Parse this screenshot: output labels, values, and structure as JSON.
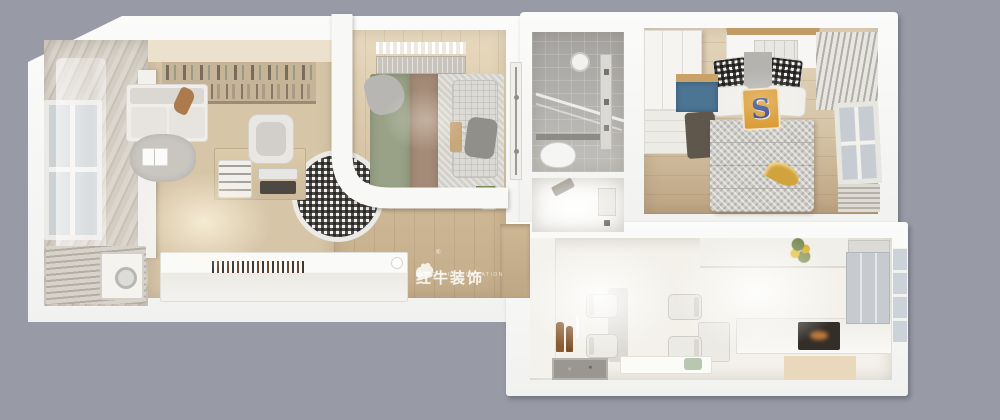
{
  "scene": {
    "description": "3D top-down interior rendering of an elongated apartment floor plan",
    "pillow_monogram": "S",
    "watermark": {
      "text_cn": "红牛装饰",
      "text_en": "HONG NIU DECORATION",
      "registered_mark": "®",
      "color": "#ffffff"
    }
  },
  "palette": {
    "bg": "#989aa6",
    "wall": "#f8f8f6",
    "wood": "#d7c5a7",
    "wood_dark": "#c3ac8a",
    "balcony_a": "#dcd7ce",
    "balcony_b": "#c7c1b6",
    "shelf": "#c6b499",
    "sofa": "#f0eeea",
    "cushion": "#dbd8d3",
    "rug": "#c9c6c0",
    "laptop": "#4d4841",
    "sage": "#99a287",
    "taupe": "#a48b77",
    "mattress": "#d3d1cb",
    "tile": "#c2c0bc",
    "bright": "#f3f1ea",
    "blue": "#4c7593",
    "orange": "#d9992f",
    "navy": "#2c3f8c",
    "gold": "#d0a33c",
    "counter_dark": "#9a9792",
    "appliance": "#332e28",
    "fridge": "#c7cace",
    "beige": "#e9d8bc",
    "door_dark": "#5f564c"
  }
}
